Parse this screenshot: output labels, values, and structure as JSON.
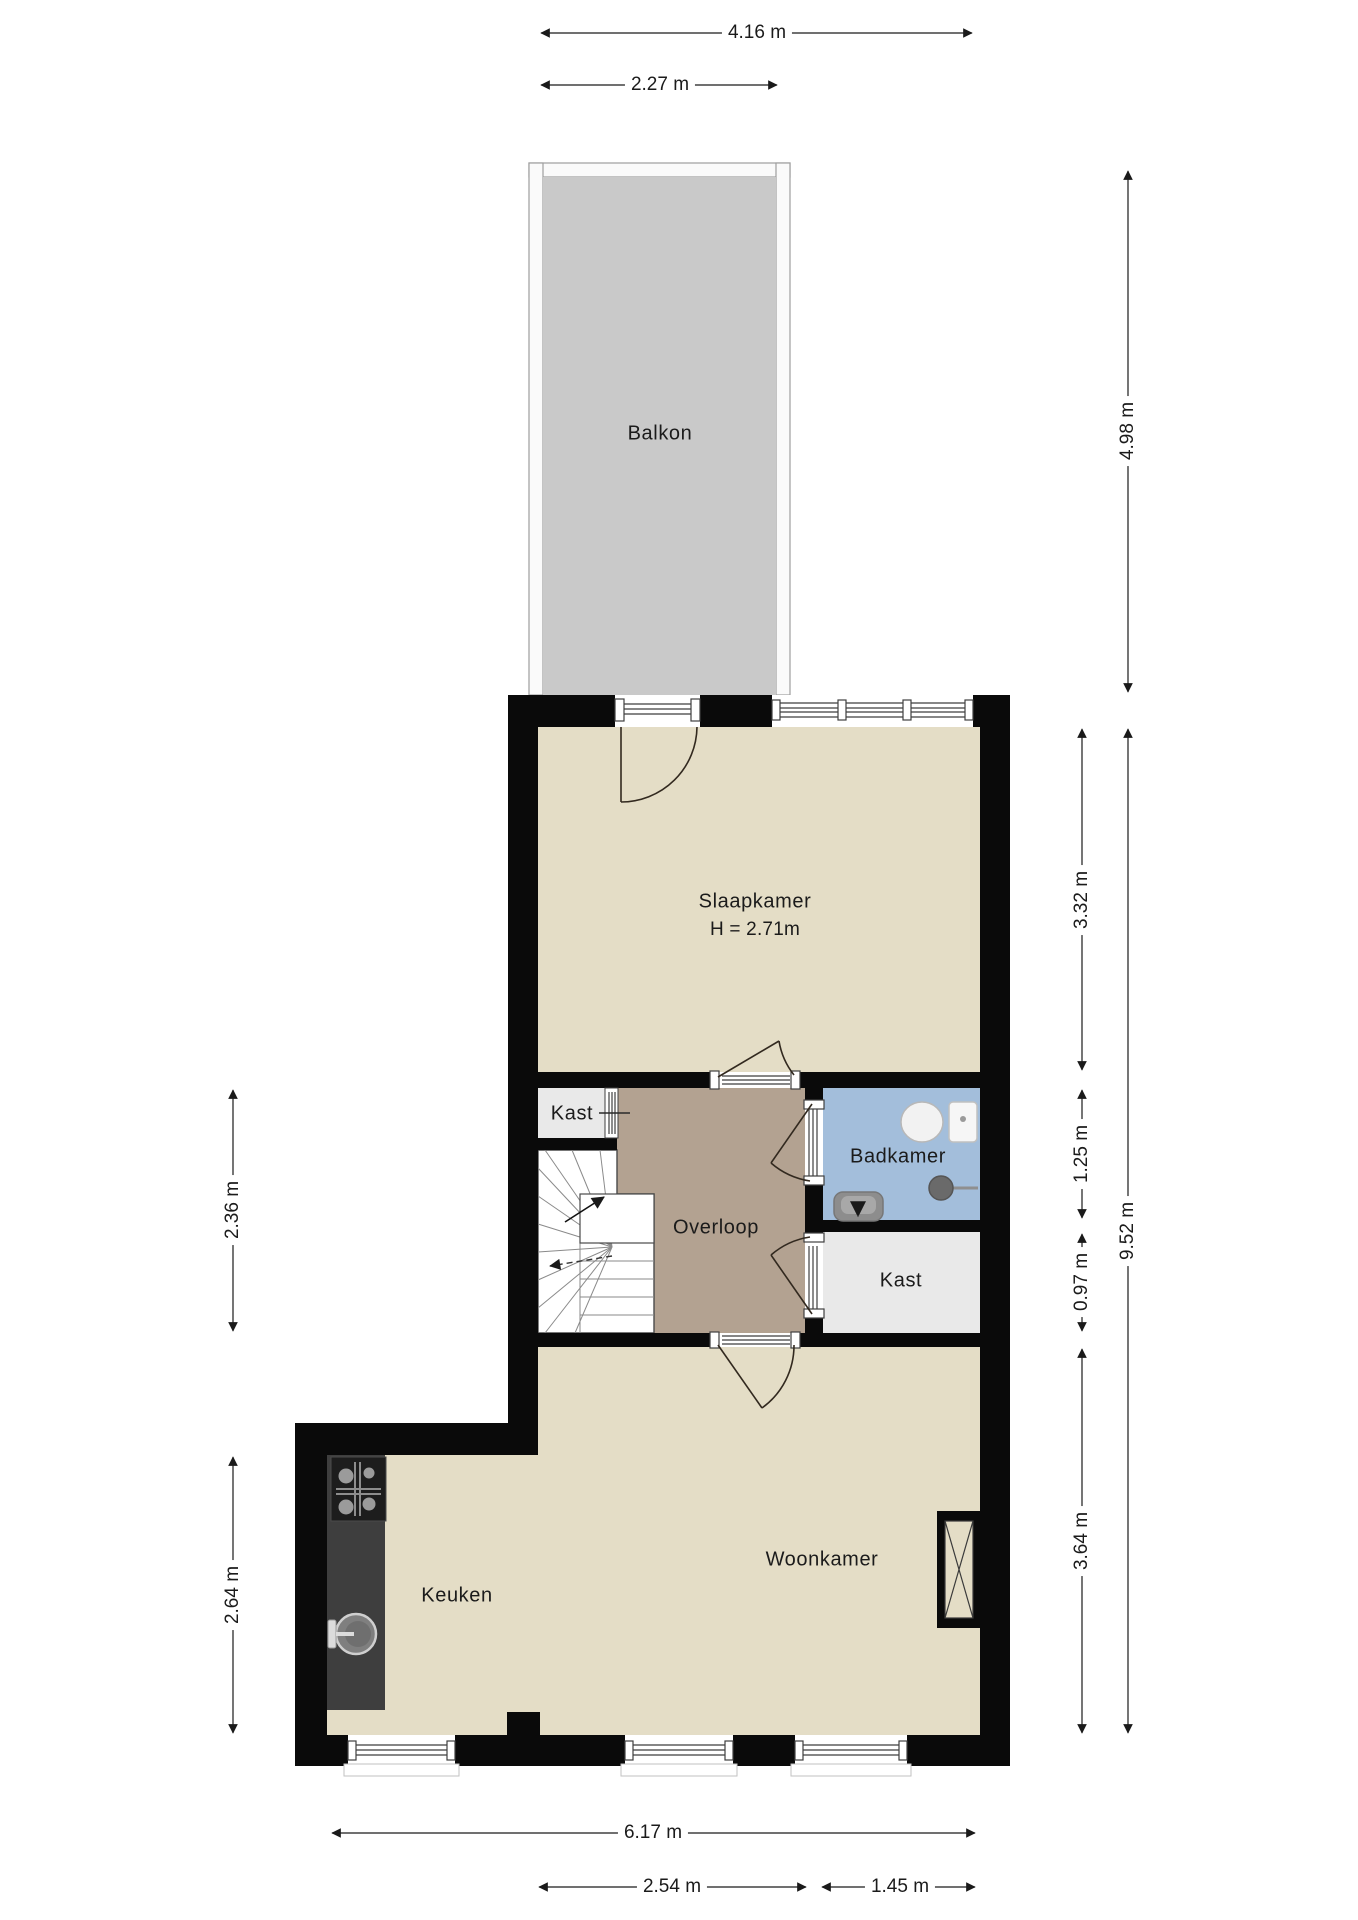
{
  "plan": {
    "title": "Floor plan",
    "rooms": {
      "balkon": {
        "label": "Balkon"
      },
      "slaapkamer": {
        "label": "Slaapkamer",
        "height_note": "H = 2.71m"
      },
      "kast_boven": {
        "label": "Kast"
      },
      "overloop": {
        "label": "Overloop"
      },
      "badkamer": {
        "label": "Badkamer"
      },
      "kast_onder": {
        "label": "Kast"
      },
      "woonkamer": {
        "label": "Woonkamer"
      },
      "keuken": {
        "label": "Keuken"
      }
    },
    "dimensions": {
      "top_total_width": "4.16 m",
      "top_balcony_width": "2.27 m",
      "right_balcony_depth": "4.98 m",
      "right_slaapkamer": "3.32 m",
      "right_badkamer": "1.25 m",
      "right_kast": "0.97 m",
      "right_woonkamer": "3.64 m",
      "right_total_depth": "9.52 m",
      "left_stairs": "2.36 m",
      "left_keuken": "2.64 m",
      "bottom_total_width": "6.17 m",
      "bottom_left_width": "2.54 m",
      "bottom_right_width": "1.45 m"
    },
    "colors": {
      "wall": "#0a0a0a",
      "room_floor": "#e4ddc6",
      "hallway_floor": "#b3a291",
      "bathroom_floor": "#a3bedb",
      "closet_floor": "#e9e9e9",
      "balcony_floor": "#c9c9c9",
      "balcony_rail": "#fafafa",
      "counter": "#3e3e3e",
      "stove": "#1d1d1d"
    }
  }
}
